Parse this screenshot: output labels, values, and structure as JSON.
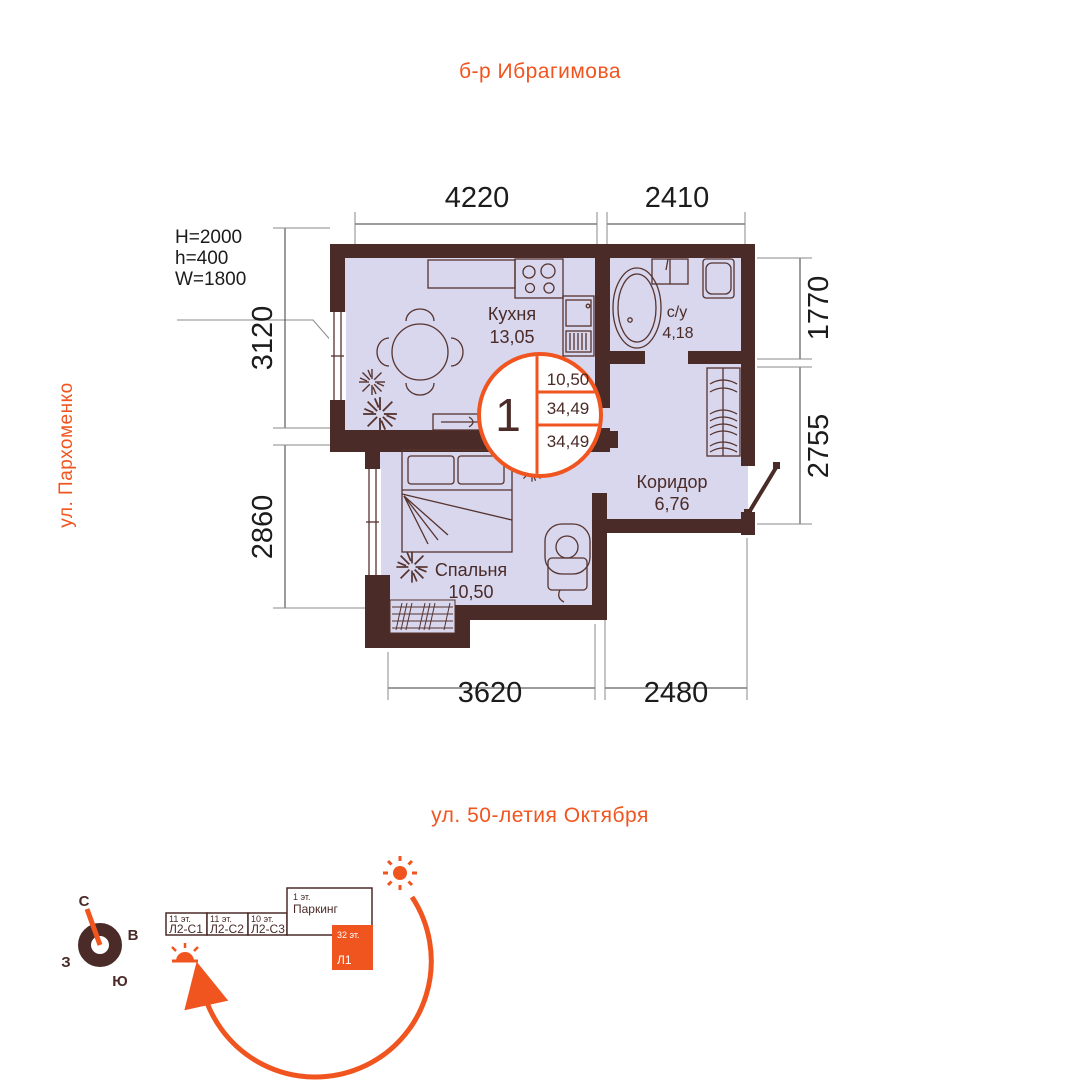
{
  "streets": {
    "top": "б-р Ибрагимова",
    "left": "ул. Пархоменко",
    "bottom": "ул. 50-летия Октября"
  },
  "window_spec": {
    "line1": "H=2000",
    "line2": "h=400",
    "line3": "W=1800"
  },
  "dimensions": {
    "top": [
      "4220",
      "2410"
    ],
    "left": [
      "3120",
      "2860"
    ],
    "right": [
      "1770",
      "2755"
    ],
    "bottom": [
      "3620",
      "2480"
    ]
  },
  "rooms": {
    "kitchen": {
      "name": "Кухня",
      "area": "13,05"
    },
    "bathroom": {
      "name": "с/у",
      "area": "4,18"
    },
    "corridor": {
      "name": "Коридор",
      "area": "6,76"
    },
    "bedroom": {
      "name": "Спальня",
      "area": "10,50"
    }
  },
  "badge": {
    "rooms": "1",
    "living_area": "10,50",
    "total_area": "34,49",
    "total_area_with_balcony": "34,49"
  },
  "compass": {
    "north": "С",
    "east": "В",
    "south": "Ю",
    "west": "З"
  },
  "site_plan": {
    "sections": [
      {
        "floors": "11 эт.",
        "label": "Л2-С1"
      },
      {
        "floors": "11 эт.",
        "label": "Л2-С2"
      },
      {
        "floors": "10 эт.",
        "label": "Л2-С3"
      }
    ],
    "parking": {
      "floors": "1 эт.",
      "label": "Паркинг"
    },
    "current": {
      "floors": "32 эт.",
      "label": "Л1"
    }
  },
  "colors": {
    "accent": "#F0551F",
    "wall": "#4A2B28",
    "floor": "#D8D7EE"
  }
}
